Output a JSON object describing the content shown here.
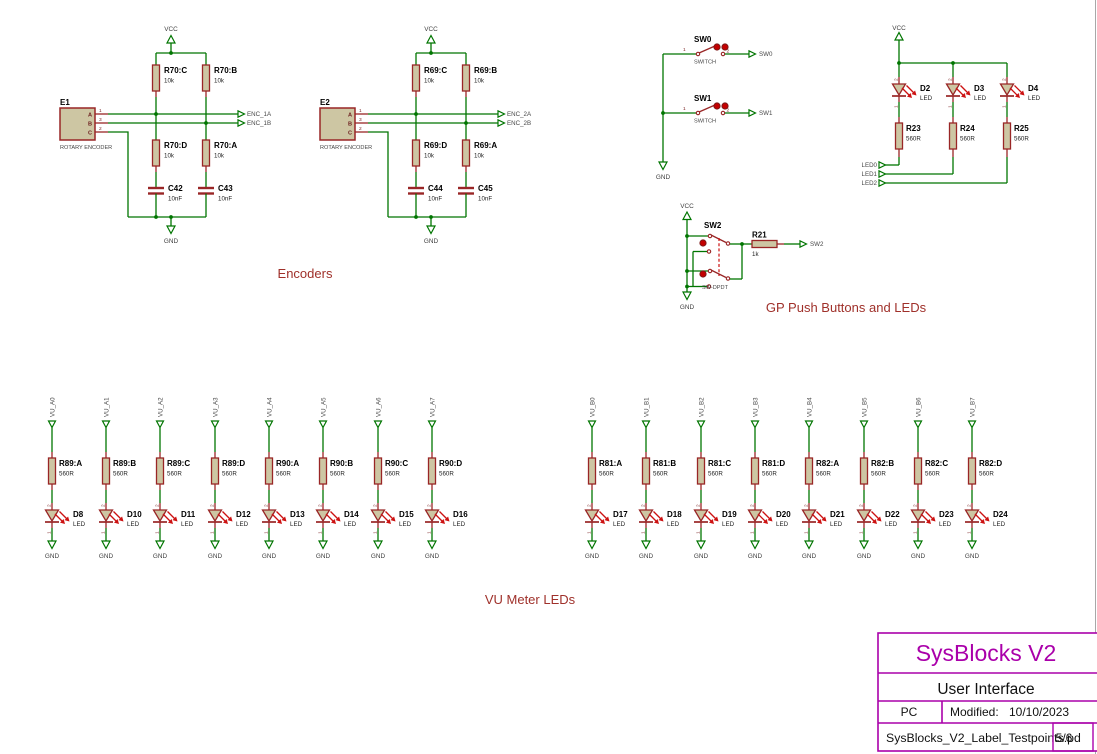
{
  "sheet": {
    "background": "#FFFFFF",
    "border_color": "#A8A8A8"
  },
  "colors": {
    "wire_green": "#007500",
    "component_maroon": "#992626",
    "body_fill_tan": "#CDC6A3",
    "accent_red": "#CC1111",
    "button_cap_red": "#C40000",
    "net_text": "#474747",
    "caption_red": "#9F302A",
    "title_magenta": "#AA00AA"
  },
  "power": {
    "vcc": "VCC",
    "gnd": "GND"
  },
  "captions": {
    "encoders": "Encoders",
    "gp": "GP Push Buttons and LEDs",
    "vu": "VU Meter LEDs"
  },
  "encoder1": {
    "ref": "E1",
    "device": "ROTARY ENCODER",
    "pin_letters": [
      "A",
      "B",
      "C"
    ],
    "pin_numbers": [
      "1",
      "3",
      "2"
    ],
    "r_top_left": {
      "ref": "R70:C",
      "value": "10k"
    },
    "r_top_right": {
      "ref": "R70:B",
      "value": "10k"
    },
    "r_bot_left": {
      "ref": "R70:D",
      "value": "10k"
    },
    "r_bot_right": {
      "ref": "R70:A",
      "value": "10k"
    },
    "cap_left": {
      "ref": "C42",
      "value": "10nF"
    },
    "cap_right": {
      "ref": "C43",
      "value": "10nF"
    },
    "net_a": "ENC_1A",
    "net_b": "ENC_1B"
  },
  "encoder2": {
    "ref": "E2",
    "device": "ROTARY ENCODER",
    "pin_letters": [
      "A",
      "B",
      "C"
    ],
    "pin_numbers": [
      "1",
      "3",
      "2"
    ],
    "r_top_left": {
      "ref": "R69:C",
      "value": "10k"
    },
    "r_top_right": {
      "ref": "R69:B",
      "value": "10k"
    },
    "r_bot_left": {
      "ref": "R69:D",
      "value": "10k"
    },
    "r_bot_right": {
      "ref": "R69:A",
      "value": "10k"
    },
    "cap_left": {
      "ref": "C44",
      "value": "10nF"
    },
    "cap_right": {
      "ref": "C45",
      "value": "10nF"
    },
    "net_a": "ENC_2A",
    "net_b": "ENC_2B"
  },
  "switches": {
    "sw0": {
      "ref": "SW0",
      "device": "SWITCH",
      "pin1": "1",
      "pin2": "2",
      "net": "SW0"
    },
    "sw1": {
      "ref": "SW1",
      "device": "SWITCH",
      "pin1": "1",
      "pin2": "2",
      "net": "SW1"
    },
    "sw2": {
      "ref": "SW2",
      "device": "SW-DPDT",
      "net": "SW2",
      "resistor_ref": "R21",
      "resistor_value": "1k"
    }
  },
  "led_pins": {
    "p1": "1",
    "p2": "2"
  },
  "gp_leds": {
    "columns": [
      {
        "d": "D2",
        "dt": "LED",
        "r": "R23",
        "rv": "560R",
        "net": "LED0"
      },
      {
        "d": "D3",
        "dt": "LED",
        "r": "R24",
        "rv": "560R",
        "net": "LED1"
      },
      {
        "d": "D4",
        "dt": "LED",
        "r": "R25",
        "rv": "560R",
        "net": "LED2"
      }
    ]
  },
  "vu_left": {
    "columns": [
      {
        "net": "VU_A0",
        "r": "R89:A",
        "rv": "560R",
        "d": "D8",
        "dt": "LED"
      },
      {
        "net": "VU_A1",
        "r": "R89:B",
        "rv": "560R",
        "d": "D10",
        "dt": "LED"
      },
      {
        "net": "VU_A2",
        "r": "R89:C",
        "rv": "560R",
        "d": "D11",
        "dt": "LED"
      },
      {
        "net": "VU_A3",
        "r": "R89:D",
        "rv": "560R",
        "d": "D12",
        "dt": "LED"
      },
      {
        "net": "VU_A4",
        "r": "R90:A",
        "rv": "560R",
        "d": "D13",
        "dt": "LED"
      },
      {
        "net": "VU_A5",
        "r": "R90:B",
        "rv": "560R",
        "d": "D14",
        "dt": "LED"
      },
      {
        "net": "VU_A6",
        "r": "R90:C",
        "rv": "560R",
        "d": "D15",
        "dt": "LED"
      },
      {
        "net": "VU_A7",
        "r": "R90:D",
        "rv": "560R",
        "d": "D16",
        "dt": "LED"
      }
    ]
  },
  "vu_right": {
    "columns": [
      {
        "net": "VU_B0",
        "r": "R81:A",
        "rv": "560R",
        "d": "D17",
        "dt": "LED"
      },
      {
        "net": "VU_B1",
        "r": "R81:B",
        "rv": "560R",
        "d": "D18",
        "dt": "LED"
      },
      {
        "net": "VU_B2",
        "r": "R81:C",
        "rv": "560R",
        "d": "D19",
        "dt": "LED"
      },
      {
        "net": "VU_B3",
        "r": "R81:D",
        "rv": "560R",
        "d": "D20",
        "dt": "LED"
      },
      {
        "net": "VU_B4",
        "r": "R82:A",
        "rv": "560R",
        "d": "D21",
        "dt": "LED"
      },
      {
        "net": "VU_B5",
        "r": "R82:B",
        "rv": "560R",
        "d": "D22",
        "dt": "LED"
      },
      {
        "net": "VU_B6",
        "r": "R82:C",
        "rv": "560R",
        "d": "D23",
        "dt": "LED"
      },
      {
        "net": "VU_B7",
        "r": "R82:D",
        "rv": "560R",
        "d": "D24",
        "dt": "LED"
      }
    ]
  },
  "title_block": {
    "title": "SysBlocks V2",
    "subtitle": "User Interface",
    "author": "PC",
    "modified_label": "Modified:",
    "modified_date": "10/10/2023",
    "filename": "SysBlocks_V2_Label_Testpoints.pd",
    "page": "5/6"
  }
}
